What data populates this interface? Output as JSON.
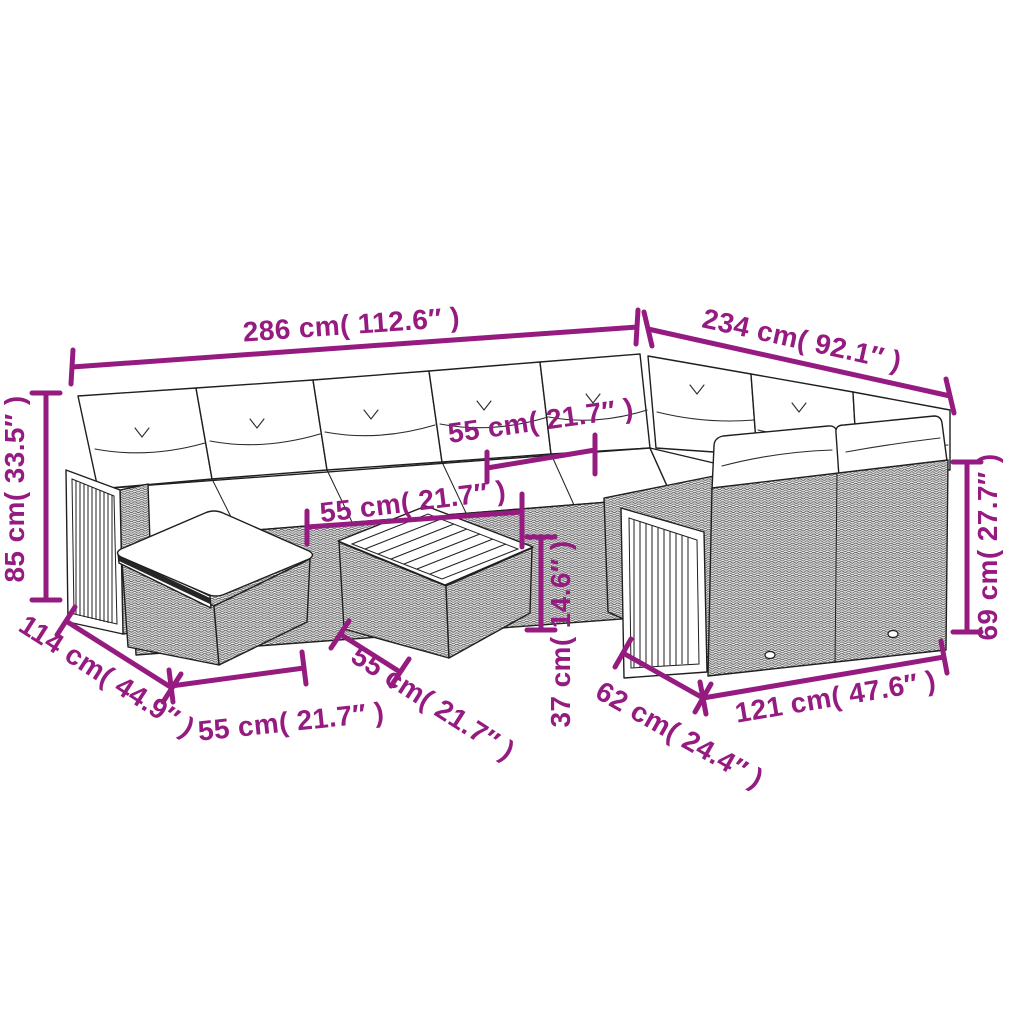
{
  "figure": {
    "type": "product-dimension-diagram",
    "subject": "Line drawing of a poly rattan garden lounge set: corner sofa with white cushions, wood slat side panels, footstool and square coffee table",
    "background": "#ffffff",
    "annotation_color": "#951b81",
    "outline_color": "#1f1f1f",
    "cushion_color": "#ffffff"
  },
  "dimensions": {
    "total_width": {
      "label": "286 cm( 112.6″ )"
    },
    "total_side": {
      "label": "234 cm( 92.1″ )"
    },
    "back_height": {
      "label": "85 cm( 33.5″ )"
    },
    "seat_width": {
      "label": "55 cm( 21.7″ )"
    },
    "table_top_width": {
      "label": "55 cm( 21.7″ )"
    },
    "seat_height": {
      "label": "37 cm( 14.6″ )"
    },
    "sofa_depth": {
      "label": "114 cm( 44.9″ )"
    },
    "stool_width": {
      "label": "55 cm( 21.7″ )"
    },
    "table_depth": {
      "label": "55 cm( 21.7″ )"
    },
    "end_seat_depth": {
      "label": "62 cm( 24.4″ )"
    },
    "end_section_width": {
      "label": "121 cm( 47.6″ )"
    },
    "end_back_height": {
      "label": "69 cm( 27.7″ )"
    }
  }
}
